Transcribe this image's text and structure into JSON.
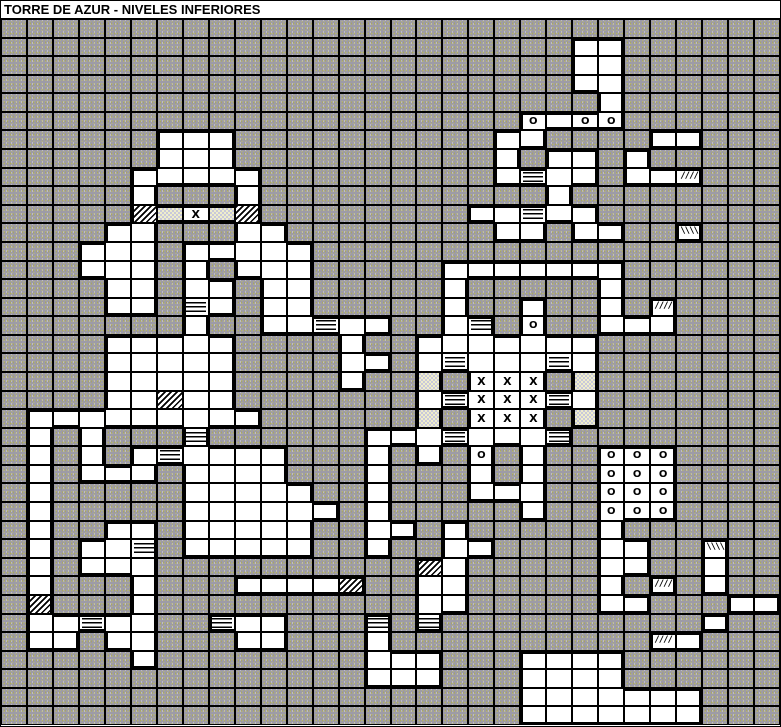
{
  "title": "TORRE DE AZUR - NIVELES INFERIORES",
  "colors": {
    "wall_base": "#9d9ba7",
    "wall_speckle1": "#bdbc72",
    "wall_speckle2": "#dedee0",
    "floor": "#ffffff",
    "line": "#000000",
    "title_bg": "#ffffff",
    "title_text": "#000000"
  },
  "legend": {
    "#": {
      "type": "wall-cell",
      "class": "wall",
      "glyph": ""
    },
    ".": {
      "type": "floor-cell",
      "class": "floor",
      "glyph": ""
    },
    "H": {
      "type": "stairs-cell",
      "class": "stairs",
      "glyph": ""
    },
    "Z": {
      "type": "hatch-cell",
      "class": "hatch",
      "glyph": ""
    },
    "D": {
      "type": "door-cell",
      "class": "dotted",
      "glyph": ""
    },
    "F": {
      "type": "slope-up-cell",
      "class": "slash",
      "glyph": "////"
    },
    "B": {
      "type": "slope-down-cell",
      "class": "backslash",
      "glyph": "\\\\\\\\"
    },
    "X": {
      "type": "marker-x-cell",
      "class": "markX",
      "glyph": "X"
    },
    "O": {
      "type": "marker-o-cell",
      "class": "markO",
      "glyph": "O"
    }
  },
  "map": {
    "cols": 30,
    "rows_count": 38,
    "rows": [
      "##############################",
      "######################..######",
      "######################..######",
      "######################..######",
      "#######################.######",
      "####################O.OO######",
      "######...##########..####..###",
      "######...##########.#..#.#####",
      "#####.....#########.H..#..F###",
      "#####.###.###########.########",
      "#####ZDXDZ########..H..#######",
      "####..###..########..#..##B###",
      "###...#.....##################",
      "###...#.#...#####.......######",
      "####..#..#..#####.#####.######",
      "####..#H.#..#####.##.##.#F####",
      "#######.##..H..##.H#O##...####",
      "####.....####.##.......#######",
      "####.....####..#.H...H.#######",
      "####.....####.##D#XXX#D#######",
      "####..Z..#######.HXXXH.#######",
      "#.........######D#XXX#D#######",
      "#.#.###H######...H...H########",
      "#.#.#.H....###.#.#O#.##OOO####",
      "#.#...#....###.###.#.##OOO####",
      "#.#####.....##.###...##OOO####",
      "#.#####......#.#####.##OOO####",
      "#.##..#.....##..#.#####.######",
      "#.#..H#.....##.##..####..##B##",
      "#.#...##########Z.#####..##.##",
      "#.###.###....Z##..#####.#F#.##",
      "#Z###.##########..#####..###..",
      "#..H..##H..###H#H##########.##",
      "#..#..###..###.##########F.###",
      "#####.########...###....######",
      "##############...###....######",
      "####################.......###",
      "####################.......###"
    ]
  }
}
